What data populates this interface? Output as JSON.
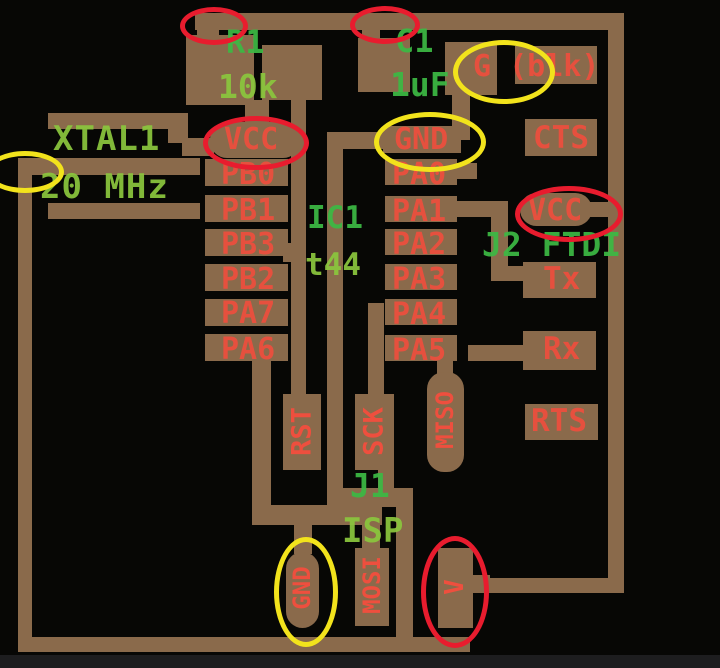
{
  "palette": {
    "background": "#070705",
    "copper": "#8a6a4b",
    "green": "#3cb944",
    "lime": "#8bc63e",
    "red_text": "#ee4f3e",
    "annotation_red": "#e81c2e",
    "annotation_yellow": "#f2e31c",
    "bottom_bar": "#1d1d1f"
  },
  "components": {
    "r1": {
      "name": "R1",
      "value": "10k"
    },
    "c1": {
      "name": "C1",
      "value": "1uF"
    },
    "xtal1": {
      "name": "XTAL1",
      "value": "20 MHz"
    },
    "ic1": {
      "name": "IC1",
      "value": "t44"
    },
    "j1": {
      "name": "J1",
      "value": "ISP"
    },
    "j2": {
      "name": "J2 FTDI"
    }
  },
  "pins": {
    "left_column": [
      "PB0",
      "PB1",
      "PB3",
      "PB2",
      "PA7",
      "PA6"
    ],
    "right_column": [
      "PA0",
      "PA1",
      "PA2",
      "PA3",
      "PA4",
      "PA5"
    ],
    "ftdi": [
      "G (blk)",
      "CTS",
      "VCC",
      "Tx",
      "Rx",
      "RTS"
    ],
    "isp_vertical": [
      "RST",
      "SCK",
      "MISO",
      "GND",
      "MOSI",
      "V"
    ],
    "power": {
      "vcc_left": "VCC",
      "gnd_top": "GND"
    }
  },
  "annotations": {
    "red_circles": [
      "top trace junction left",
      "top trace junction right",
      "VCC left",
      "VCC right",
      "V bottom"
    ],
    "yellow_circles": [
      "left edge trace",
      "G (blk)",
      "GND top",
      "GND bottom"
    ]
  }
}
